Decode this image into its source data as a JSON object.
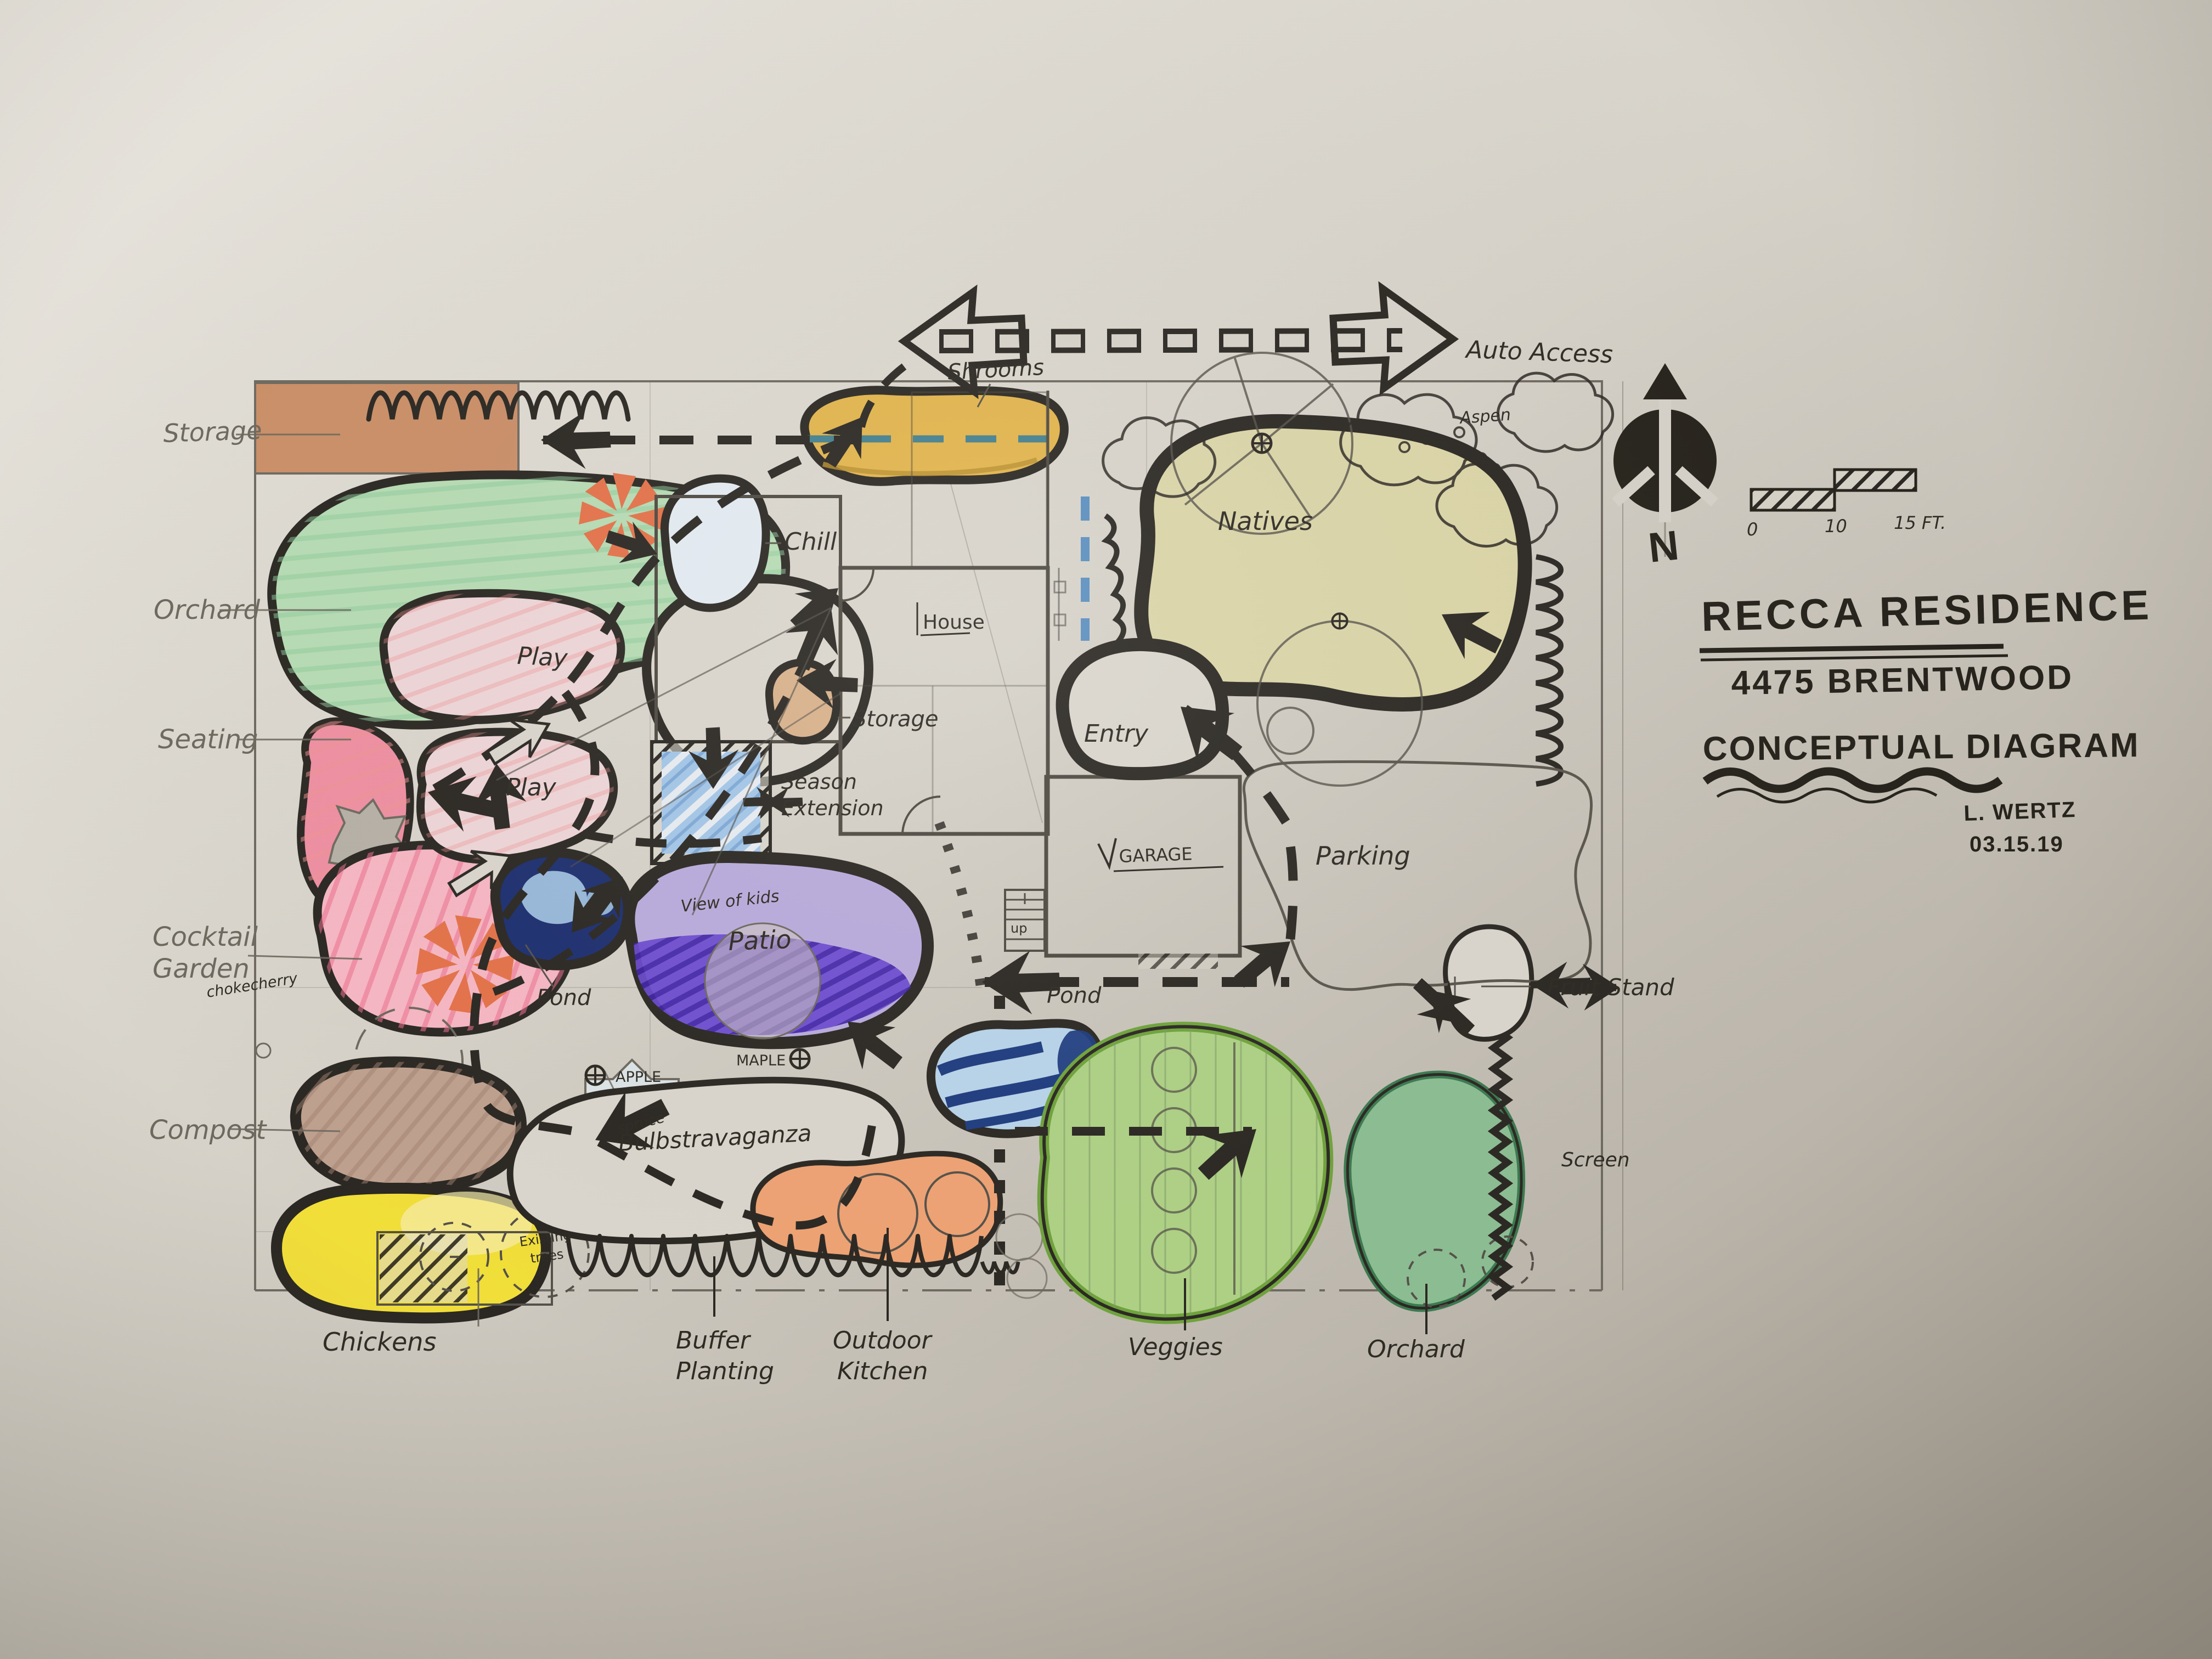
{
  "title_block": {
    "project": "RECCA RESIDENCE",
    "address": "4475 BRENTWOOD",
    "doc_type": "CONCEPTUAL DIAGRAM",
    "author": "L. WERTZ",
    "date": "03.15.19"
  },
  "compass": {
    "north": "N"
  },
  "scale_bar": {
    "zero": "0",
    "ten": "10",
    "fifteen": "15 FT."
  },
  "labels": {
    "auto_access": "Auto Access",
    "shrooms": "Shrooms",
    "aspen": "Aspen",
    "natives": "Natives",
    "storage_yard": "Storage",
    "orchard_west": "Orchard",
    "seating": "Seating",
    "cocktail_1": "Cocktail",
    "cocktail_2": "Garden",
    "chokecherry": "chokecherry",
    "compost": "Compost",
    "chickens": "Chickens",
    "spruce": "spruce",
    "play_upper": "Play",
    "play_lower": "Play",
    "chill": "Chill",
    "house": "House",
    "storage_house": "Storage",
    "season_1": "Season",
    "season_2": "Extension",
    "view_of_kids": "View of kids",
    "patio": "Patio",
    "pond_west": "Pond",
    "apple": "APPLE",
    "maple": "MAPLE",
    "bulbstravaganza": "Bulbstravaganza",
    "existing_1": "Existing",
    "existing_2": "trees",
    "buffer_1": "Buffer",
    "buffer_2": "Planting",
    "outdoor_1": "Outdoor",
    "outdoor_2": "Kitchen",
    "pond_south": "Pond",
    "veggies": "Veggies",
    "orchard_south": "Orchard",
    "entry": "Entry",
    "garage": "GARAGE",
    "up": "up",
    "parking": "Parking",
    "fruit_stand": "Fruit Stand",
    "screen": "Screen"
  },
  "colors": {
    "paper": "#d6d2c9",
    "ink": "#2b2823",
    "pencil": "#6e695f",
    "orchard_green": "#b7dcb4",
    "veggies_green": "#aed185",
    "orchard_south_green": "#8cbd92",
    "natives_olive": "#dbd5a8",
    "play_pink": "#eed6d8",
    "seating_pink": "#ee8fa2",
    "cocktail_pink": "#f6b7c3",
    "compost_brown": "#bfa08f",
    "chicken_yellow": "#f1de39",
    "storage_terracotta": "#c8895e",
    "storage_tan": "#d8b18b",
    "shroom_gold": "#e2b44c",
    "season_blue": "#a3c6e8",
    "patio_lavender": "#b9abdc",
    "patio_purple": "#5636c5",
    "pond_navy": "#1d2f70",
    "pond_light_blue": "#b8d4ea",
    "kitchen_orange": "#eea273",
    "conifer_orange": "#e4724a",
    "teal": "#44808e"
  }
}
